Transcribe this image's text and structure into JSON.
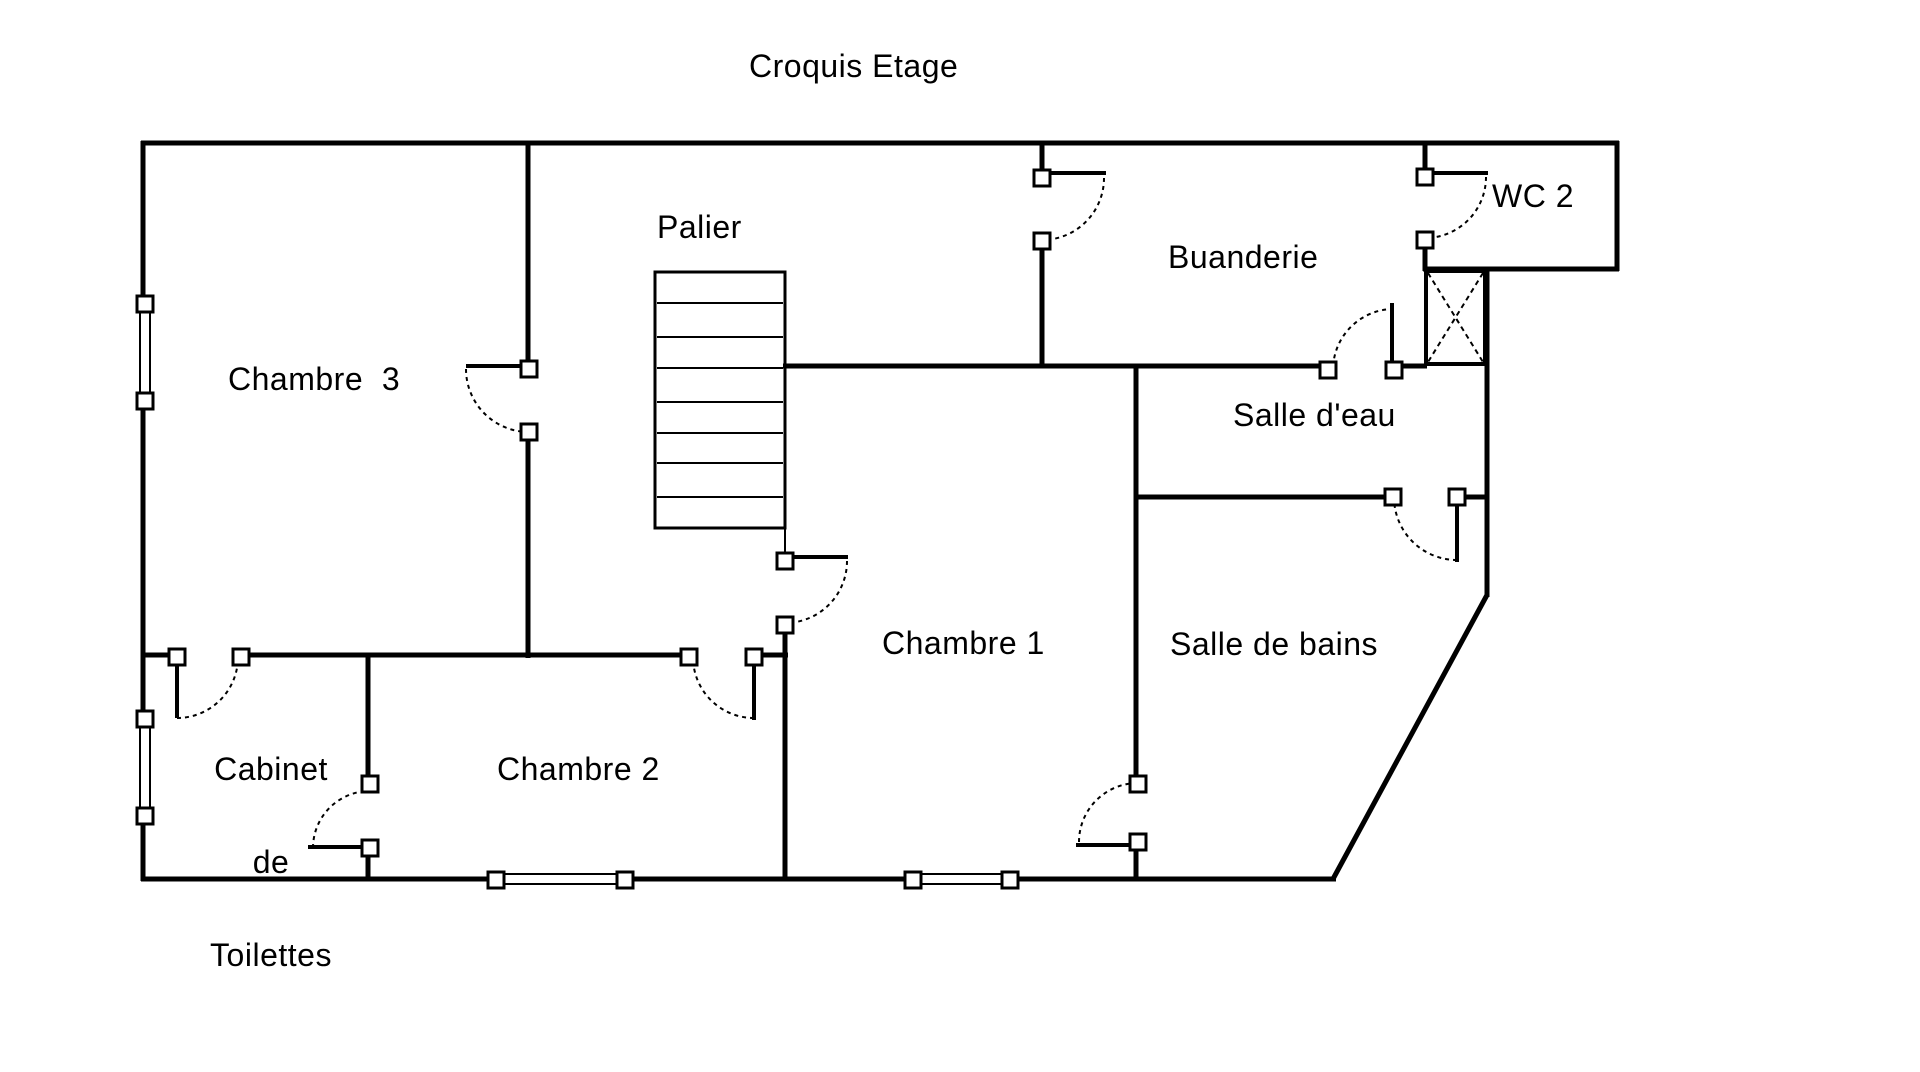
{
  "title": "Croquis Etage",
  "rooms": {
    "palier": "Palier",
    "chambre3": "Chambre  3",
    "chambre2": "Chambre 2",
    "chambre1": "Chambre 1",
    "buanderie": "Buanderie",
    "wc2": "WC 2",
    "salle_eau": "Salle d'eau",
    "salle_bains": "Salle de bains",
    "cabinet_l1": "Cabinet",
    "cabinet_l2": "de",
    "cabinet_l3": "Toilettes"
  },
  "colors": {
    "line": "#000000",
    "background": "#ffffff",
    "text": "#000000"
  }
}
